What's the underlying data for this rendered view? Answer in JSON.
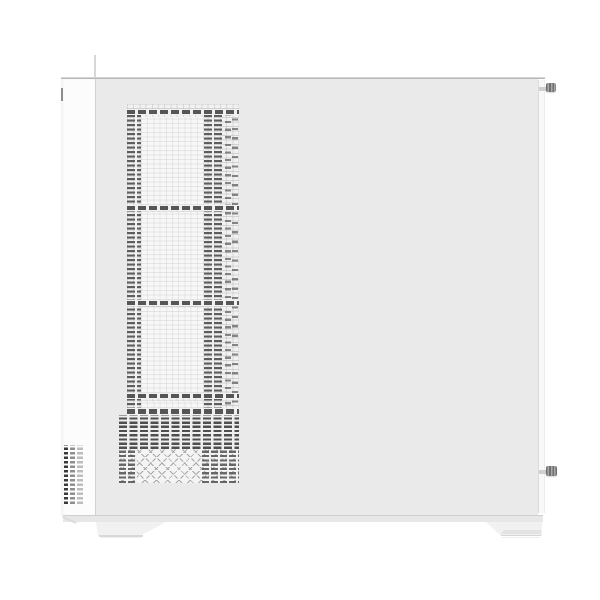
{
  "scene": {
    "type": "product-photo",
    "subject": "White mid-tower PC case, side view with perforated ventilation panel",
    "background_color": "#ffffff",
    "palette": {
      "front_panel": "#fcfcfc",
      "side_panel": "#eaeaea",
      "back_edge": "#f8f8f8",
      "mesh_dark": "#5a5a5a",
      "mesh_light_grid": "#dcdcdc",
      "seam_line": "#b8b8b8",
      "bottom_trim": "#e7e7e7",
      "foot": "#f1f1f1",
      "thumbscrew": "#8a8a8a",
      "vent_slot_dark": "#383838"
    },
    "parts": {
      "front_panel": {
        "label": "Front panel (white)"
      },
      "side_panel": {
        "label": "Side panel (light grey)"
      },
      "mesh_field": {
        "label": "Perforated mesh ventilation strip"
      },
      "fan_cutouts": {
        "label": "Fan mount openings seen through mesh",
        "count": 3
      },
      "dense_band": {
        "label": "Dense perforation band (PSU area)"
      },
      "zigzag_band": {
        "label": "Lattice vent band (bottom)"
      },
      "front_vents": {
        "label": "Front edge intake slots",
        "rows": 13
      },
      "top_seam": {
        "label": "Top panel seam"
      },
      "back_strip": {
        "label": "Rear panel edge"
      },
      "thumbscrew_top": {
        "label": "Top rear thumbscrew"
      },
      "thumbscrew_bottom": {
        "label": "Bottom rear thumbscrew"
      },
      "foot_left": {
        "label": "Left case foot"
      },
      "foot_right": {
        "label": "Right case foot"
      },
      "bottom_trim": {
        "label": "Bottom chassis trim"
      }
    }
  }
}
